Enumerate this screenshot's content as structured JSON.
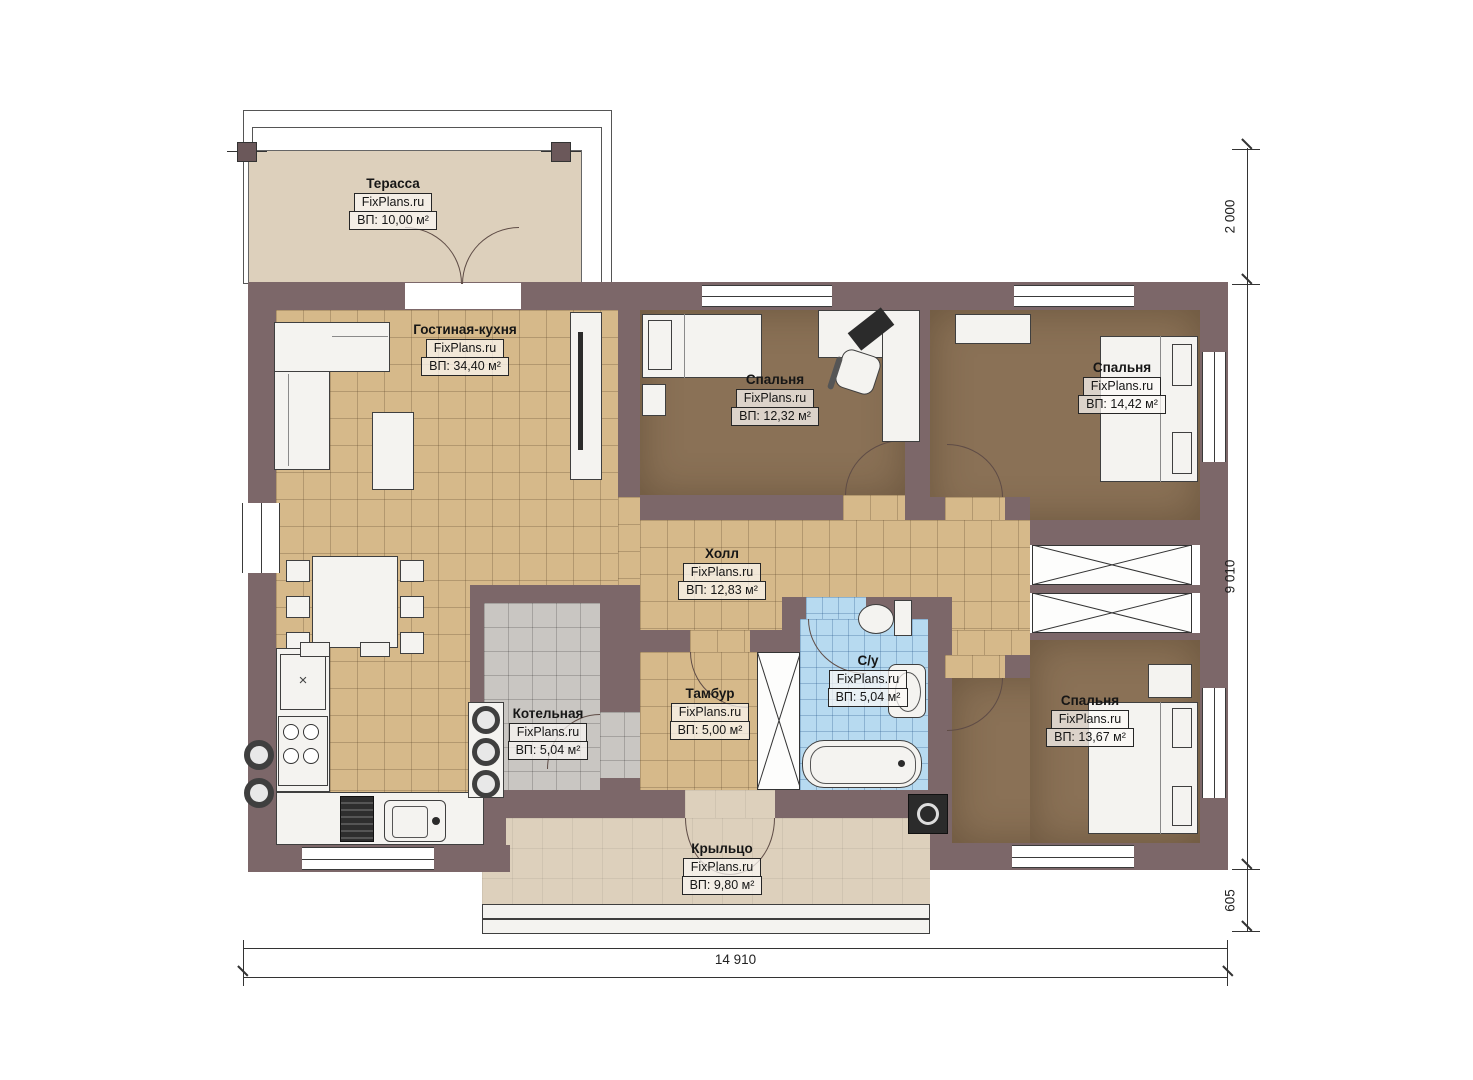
{
  "plan": {
    "brand": "FixPlans.ru",
    "rooms": [
      {
        "key": "terrace",
        "name": "Терасса",
        "area": "ВП: 10,00 м²"
      },
      {
        "key": "living-kitchen",
        "name": "Гостиная-кухня",
        "area": "ВП: 34,40 м²"
      },
      {
        "key": "bedroom-top-middle",
        "name": "Спальня",
        "area": "ВП: 12,32 м²"
      },
      {
        "key": "bedroom-top-right",
        "name": "Спальня",
        "area": "ВП: 14,42 м²"
      },
      {
        "key": "hall",
        "name": "Холл",
        "area": "ВП: 12,83 м²"
      },
      {
        "key": "boiler-room",
        "name": "Котельная",
        "area": "ВП: 5,04 м²"
      },
      {
        "key": "vestibule",
        "name": "Тамбур",
        "area": "ВП: 5,00 м²"
      },
      {
        "key": "bathroom",
        "name": "С/у",
        "area": "ВП: 5,04 м²"
      },
      {
        "key": "bedroom-bottom-right",
        "name": "Спальня",
        "area": "ВП: 13,67 м²"
      },
      {
        "key": "porch",
        "name": "Крыльцо",
        "area": "ВП: 9,80 м²"
      }
    ],
    "dimensions": {
      "total_width": "14 910",
      "main_depth": "9 010",
      "terrace_depth": "2 000",
      "porch_depth": "605"
    },
    "icons": {
      "fridge_mark": "×"
    },
    "colors": {
      "wall": "#7c6769",
      "floor_tile_tan": "#d6b98a",
      "floor_brown": "#8a7156",
      "floor_gray": "#c9c6c2",
      "floor_blue": "#b7daf0",
      "floor_beige": "#ddd0bc",
      "furniture": "#f4f3f0",
      "outline": "#3a3a3a"
    }
  }
}
